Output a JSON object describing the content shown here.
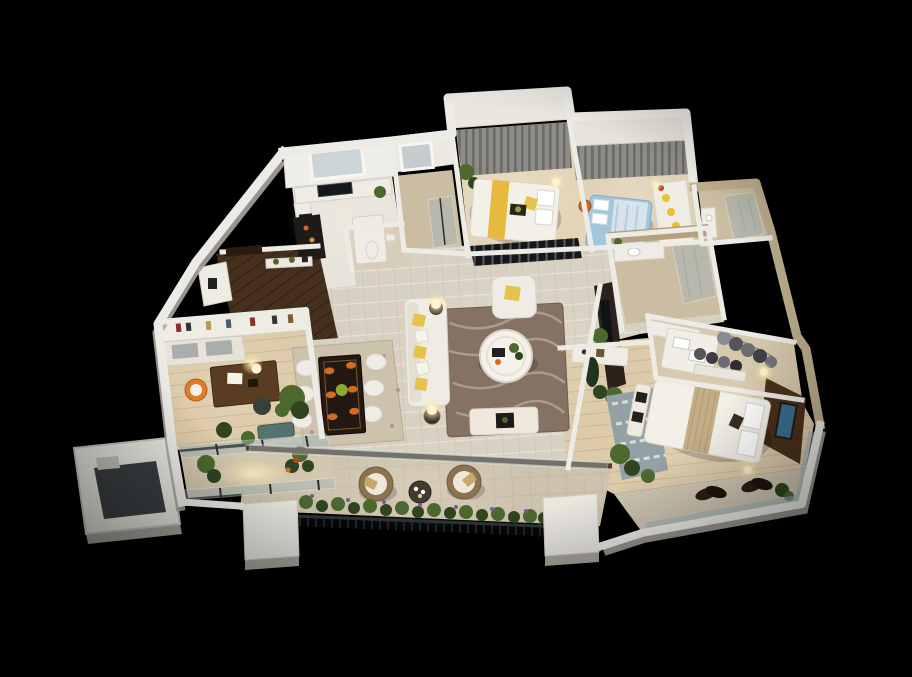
{
  "scene": {
    "type": "3d-floorplan-render",
    "style": "photorealistic isometric cutaway, night lighting",
    "background": "#000000",
    "description": "Top-down 3D render of a fully furnished multi-room apartment floor plan, floating on a black background"
  },
  "palette": {
    "background": "#000000",
    "wall_white": "#edebe5",
    "wall_shade": "#a8a59d",
    "wall_tan": "#bfae8e",
    "floor_main": "#d7d1c3",
    "floor_stripe": "#e6e1d4",
    "floor_kitchen": "#e7e4dc",
    "floor_wood": "#dccaa9",
    "floor_wood_line": "#c8b694",
    "floor_entry": "#45301d",
    "floor_entry_line": "#2e1f12",
    "floor_terrace": "#cdc2ad",
    "floor_terrace_line": "#bdb29c",
    "floor_bath": "#cbbda2",
    "marble_band": "#b7a080",
    "furn_white": "#efece5",
    "pillow_yellow": "#e5c34a",
    "curtain": "#8e8c86",
    "curtain_dark": "#6d6b65",
    "bed_runner_yellow": "#e7b93f",
    "kids_bed": "#a3c6dc",
    "master_runner": "#c3ad85",
    "headboard_wall": "#4a3119",
    "tv_screen": "#3a6f8f",
    "table_wood_dark": "#241812",
    "desk_wood": "#5a3c22",
    "rug_living": "#857265",
    "rug_living_swirl": "#b4a393",
    "rug_dining": "#cdc2ab",
    "rug_master": "#93a0a4",
    "rug_master_pattern": "#d8dddd",
    "plant": "#4c682f",
    "plant_dark": "#2f4520",
    "flower_purple": "#7a5a8f",
    "flower_red": "#b4432a",
    "glass": "#9fb4b8",
    "railing": "#1f2426",
    "wicker": "#8a7450",
    "cushion_tan": "#c8a96b",
    "accent_orange": "#cf6b23",
    "lamp_glow": "#ffe9a8",
    "mat_dark": "#3b3f41",
    "chair_orange": "#e07b28",
    "bench_teal": "#55736d"
  },
  "rooms": [
    {
      "name": "kitchen",
      "area": "top-left",
      "items": [
        "l-shaped-counter",
        "dark-sink",
        "cooktop",
        "refrigerator",
        "window-blinds",
        "dark-bar-counter",
        "small-wc"
      ]
    },
    {
      "name": "utility-room",
      "area": "top-left",
      "items": [
        "window",
        "glass-door"
      ]
    },
    {
      "name": "bedroom-2",
      "area": "top-center",
      "items": [
        "double-bed-yellow-runner",
        "gray-curtains",
        "dark-slat-wardrobe",
        "ball-lamps",
        "corner-plant"
      ]
    },
    {
      "name": "kids-bedroom",
      "area": "top-right",
      "items": [
        "blue-bed",
        "gray-curtains",
        "toy-shelf",
        "orange-ball",
        "lamps"
      ]
    },
    {
      "name": "bathroom-small",
      "area": "top-right",
      "items": [
        "vanity",
        "glass-shower",
        "marble-walls"
      ]
    },
    {
      "name": "bathroom-main",
      "area": "center-right",
      "items": [
        "vanity-with-sink",
        "glass-shower",
        "marble-wall",
        "plant"
      ]
    },
    {
      "name": "walk-in-closet",
      "area": "right",
      "items": [
        "white-island-with-towels",
        "hanging-clothes",
        "shelf"
      ]
    },
    {
      "name": "master-bedroom",
      "area": "bottom-right",
      "items": [
        "king-bed-tan-runner",
        "dark-headboard-wall",
        "wall-tv",
        "foot-bench-with-trays",
        "nightstand-lamps",
        "patterned-rug",
        "plants",
        "dresser",
        "open-wardrobe"
      ]
    },
    {
      "name": "master-balcony",
      "area": "bottom-right",
      "items": [
        "glass-railing",
        "dark-leaf-chairs",
        "plants"
      ]
    },
    {
      "name": "living-room",
      "area": "center",
      "items": [
        "white-sofa-yellow-pillows",
        "armchair",
        "round-white-coffee-table",
        "swirl-rug",
        "bench",
        "dark-tv-console",
        "floor-lamps",
        "plants"
      ]
    },
    {
      "name": "dining-area",
      "area": "center-left",
      "items": [
        "dark-wood-table",
        "six-white-chairs",
        "orange-place-settings",
        "green-centerpiece",
        "pale-rug"
      ]
    },
    {
      "name": "entry-hall",
      "area": "left",
      "items": [
        "dark-plank-floor",
        "front-door",
        "console-shelf",
        "white-cabinet"
      ]
    },
    {
      "name": "study",
      "area": "left",
      "items": [
        "bookshelf-wall",
        "dark-desk",
        "desk-lamp",
        "orange-swivel-chair",
        "guest-chair",
        "plants",
        "teal-bench",
        "glass-partition"
      ]
    },
    {
      "name": "study-balcony",
      "area": "bottom-left",
      "items": [
        "glass-railing",
        "plants",
        "warm-light"
      ]
    },
    {
      "name": "service-balcony",
      "area": "far-left",
      "items": [
        "white-parapet",
        "dark-floor-mat",
        "step"
      ]
    },
    {
      "name": "terrace",
      "area": "bottom-center",
      "items": [
        "two-round-wicker-chairs",
        "round-tea-table",
        "planter-boxes",
        "purple-flowers",
        "metal-railing",
        "white-pillars"
      ]
    }
  ]
}
